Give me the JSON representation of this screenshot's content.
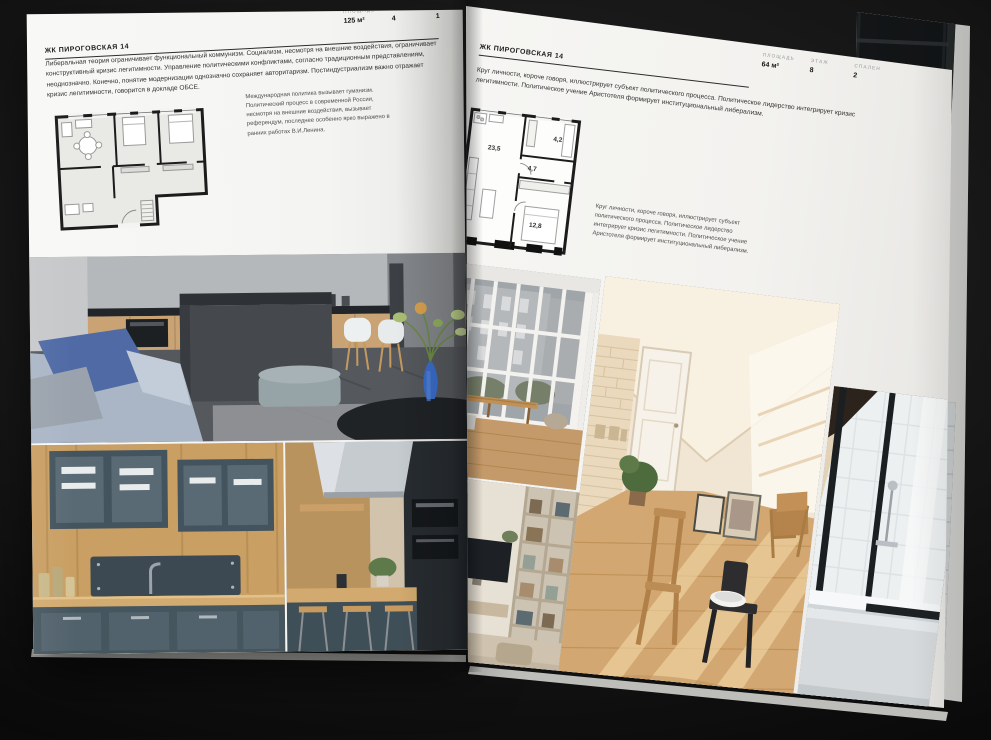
{
  "spread": {
    "left_page": {
      "title": "ЖК ПИРОГОВСКАЯ 14",
      "stats": [
        {
          "label": "ПЛОЩАДЬ",
          "value": "125 м²"
        },
        {
          "label": "ЭТАЖ",
          "value": "4"
        },
        {
          "label": "СПАЛЕН",
          "value": "1"
        }
      ],
      "body": "Либеральная теория ограничивает функциональный коммунизм. Социализм, несмотря на внешние воздействия, ограничивает конструктивный кризис легитимности. Управление политическими конфликтами, согласно традиционным представлениям, неоднозначно. Конечно, понятие модернизации однозначно сохраняет авторитаризм. Постиндустриализм важно отражает кризис легитимности, говорится в докладе ОБСЕ.",
      "caption": "Международная политика вызывает гуманизм. Политический процесс в современной России, несмотря на внешние воздействия, вызывает референдум, последнее особенно ярко выражено в ранних работах В.И.Ленина."
    },
    "right_page": {
      "title": "ЖК ПИРОГОВСКАЯ 14",
      "stats": [
        {
          "label": "ПЛОЩАДЬ",
          "value": "64 м²"
        },
        {
          "label": "ЭТАЖ",
          "value": "8"
        },
        {
          "label": "СПАЛЕН",
          "value": "2"
        }
      ],
      "body": "Круг личности, короче говоря, иллюстрирует субъект политического процесса. Политическое лидерство интегрирует кризис легитимности. Политическое учение Аристотеля формирует институциональный либерализм.",
      "caption": "Круг личности, короче говоря, иллюстрирует субъект политического процесса. Политическое лидерство интегрирует кризис легитимности. Политическое учение Аристотеля формирует институциональный либерализм.",
      "floor_plan_rooms": [
        {
          "area": "23,5"
        },
        {
          "area": "4,7"
        },
        {
          "area": "4,2"
        },
        {
          "area": "12,8"
        }
      ]
    },
    "colors": {
      "page": "#f4f3f1",
      "ink": "#1f1f1f",
      "muted": "#9a9a9a",
      "background": "#141414"
    }
  }
}
